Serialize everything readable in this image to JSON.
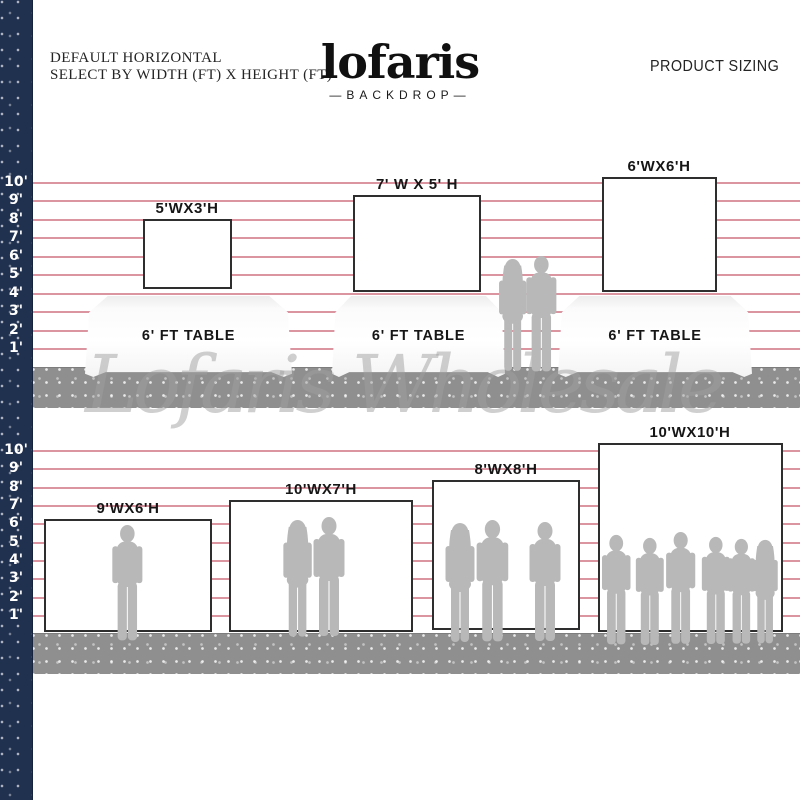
{
  "header": {
    "subtitle_line1": "DEFAULT HORIZONTAL",
    "subtitle_line2": "SELECT BY WIDTH (FT) X HEIGHT (FT)",
    "logo": "lofaris",
    "logo_tagline": "—BACKDROP—",
    "right_label": "PRODUCT SIZING"
  },
  "watermark": "Lofaris Wholesale",
  "ruler": {
    "top": [
      "10'",
      "9'",
      "8'",
      "7'",
      "6'",
      "5'",
      "4'",
      "3'",
      "2'",
      "1'"
    ],
    "bottom": [
      "10'",
      "9'",
      "8'",
      "7'",
      "6'",
      "5'",
      "4'",
      "3'",
      "2'",
      "1'"
    ]
  },
  "top_row": {
    "backdrops": [
      {
        "label": "5'WX3'H",
        "width_ft": 5,
        "height_ft": 3
      },
      {
        "label": "7' W X 5' H",
        "width_ft": 7,
        "height_ft": 5
      },
      {
        "label": "6'WX6'H",
        "width_ft": 6,
        "height_ft": 6
      }
    ],
    "tables": [
      {
        "label": "6' FT TABLE"
      },
      {
        "label": "6' FT TABLE"
      },
      {
        "label": "6' FT TABLE"
      }
    ]
  },
  "bottom_row": {
    "backdrops": [
      {
        "label": "9'WX6'H",
        "width_ft": 9,
        "height_ft": 6,
        "people_shown": 1
      },
      {
        "label": "10'WX7'H",
        "width_ft": 10,
        "height_ft": 7,
        "people_shown": 2
      },
      {
        "label": "8'WX8'H",
        "width_ft": 8,
        "height_ft": 8,
        "people_shown": 3
      },
      {
        "label": "10'WX10'H",
        "width_ft": 10,
        "height_ft": 10,
        "people_shown": 6
      }
    ]
  },
  "colors": {
    "navy_strip": "#20304f",
    "grid_line_pink": "#d68a97",
    "floor_gray": "#8f8f8f",
    "silhouette_gray": "#b8b8b8",
    "backdrop_border": "#2e2e2e",
    "watermark_gray": "#9f9f9f"
  }
}
